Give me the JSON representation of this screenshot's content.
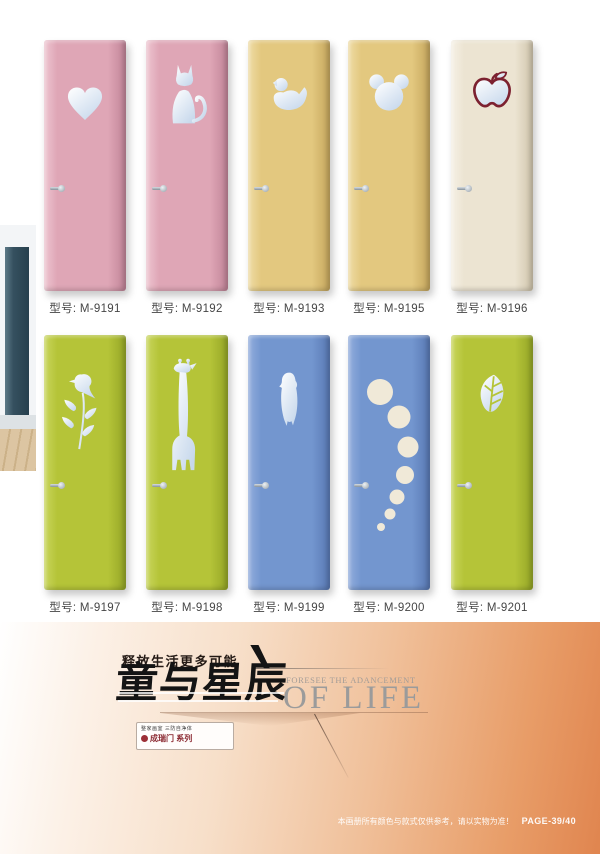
{
  "doors": [
    {
      "model": "型号: M-9191",
      "icon": "heart",
      "fill": "#dfa6b6",
      "light": "#eec6d1",
      "edge": "#c08397"
    },
    {
      "model": "型号: M-9192",
      "icon": "cat",
      "fill": "#dfa6b6",
      "light": "#eec6d1",
      "edge": "#c08397"
    },
    {
      "model": "型号: M-9193",
      "icon": "duck",
      "fill": "#e3c87f",
      "light": "#efdca6",
      "edge": "#c4a55c"
    },
    {
      "model": "型号: M-9195",
      "icon": "mickey",
      "fill": "#e3c87f",
      "light": "#efdca6",
      "edge": "#c4a55c"
    },
    {
      "model": "型号: M-9196",
      "icon": "apple",
      "fill": "#ece4d2",
      "light": "#f6f1e6",
      "edge": "#cfc4ab"
    },
    {
      "model": "型号: M-9197",
      "icon": "bird",
      "fill": "#b5c438",
      "light": "#c9d65e",
      "edge": "#94a526"
    },
    {
      "model": "型号: M-9198",
      "icon": "giraffe",
      "fill": "#b5c438",
      "light": "#c9d65e",
      "edge": "#94a526"
    },
    {
      "model": "型号: M-9199",
      "icon": "penguin",
      "fill": "#7396cf",
      "light": "#93aedd",
      "edge": "#5878b3"
    },
    {
      "model": "型号: M-9200",
      "icon": "bubbles",
      "fill": "#7396cf",
      "light": "#93aedd",
      "edge": "#5878b3"
    },
    {
      "model": "型号: M-9201",
      "icon": "leaf",
      "fill": "#b5c438",
      "light": "#c9d65e",
      "edge": "#94a526"
    }
  ],
  "footer": {
    "slogan": "释放生活更多可能",
    "title": "童与星辰",
    "subtitle_line1": "FORESEE THE ADANCEMENT",
    "subtitle_line2": "OF LIFE",
    "logo_line1": "整家画室 三防自净体",
    "logo_line2": "成瑞门 系列",
    "disclaimer": "本画册所有颜色与款式仅供参考，请以实物为准！",
    "page_number": "PAGE-39/40"
  },
  "colors": {
    "silver_cutout_light": "#ffffff",
    "silver_cutout_dark": "#c7d8ec",
    "apple_outline": "#7c2130",
    "bubble_fill": "#f0e9d8",
    "footer_gradient_start": "#fdf6ef",
    "footer_gradient_end": "#e0854f"
  }
}
